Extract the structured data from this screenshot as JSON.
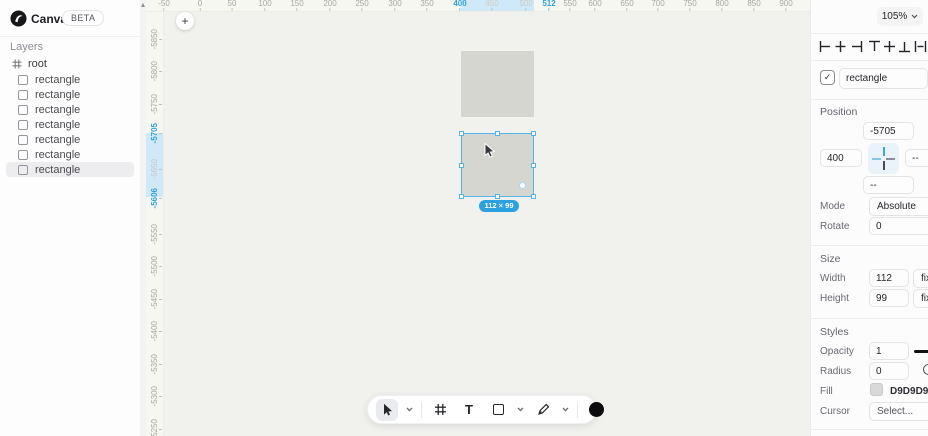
{
  "app": {
    "title": "Canvas",
    "badge": "BETA"
  },
  "sidebar": {
    "layers_title": "Layers",
    "root_label": "root",
    "items": [
      {
        "label": "rectangle"
      },
      {
        "label": "rectangle"
      },
      {
        "label": "rectangle"
      },
      {
        "label": "rectangle"
      },
      {
        "label": "rectangle"
      },
      {
        "label": "rectangle"
      },
      {
        "label": "rectangle",
        "c": "selected"
      }
    ]
  },
  "canvas": {
    "zoom_label": "105%",
    "plus_label": "+",
    "size_badge": "112 × 99",
    "ruler_top": [
      {
        "t": "-50",
        "x": 18
      },
      {
        "t": "0",
        "x": 54
      },
      {
        "t": "50",
        "x": 86
      },
      {
        "t": "100",
        "x": 119
      },
      {
        "t": "150",
        "x": 151
      },
      {
        "t": "200",
        "x": 184
      },
      {
        "t": "250",
        "x": 216
      },
      {
        "t": "300",
        "x": 249
      },
      {
        "t": "350",
        "x": 281
      },
      {
        "t": "400",
        "x": 314,
        "c": "accent"
      },
      {
        "t": "450",
        "x": 346,
        "c": "faint"
      },
      {
        "t": "500",
        "x": 380,
        "c": "faint"
      },
      {
        "t": "512",
        "x": 403,
        "c": "accent"
      },
      {
        "t": "550",
        "x": 424
      },
      {
        "t": "600",
        "x": 449
      },
      {
        "t": "650",
        "x": 481
      },
      {
        "t": "700",
        "x": 512
      },
      {
        "t": "750",
        "x": 544
      },
      {
        "t": "800",
        "x": 576
      },
      {
        "t": "850",
        "x": 608
      },
      {
        "t": "900",
        "x": 640
      }
    ],
    "ruler_left": [
      {
        "t": "-5850",
        "y": 28
      },
      {
        "t": "-5800",
        "y": 60
      },
      {
        "t": "-5750",
        "y": 93
      },
      {
        "t": "-5705",
        "y": 122,
        "c": "accent"
      },
      {
        "t": "-5650",
        "y": 158,
        "c": "faint"
      },
      {
        "t": "-5606",
        "y": 187,
        "c": "accent"
      },
      {
        "t": "-5550",
        "y": 223
      },
      {
        "t": "-5500",
        "y": 255
      },
      {
        "t": "-5450",
        "y": 288
      },
      {
        "t": "-5400",
        "y": 320
      },
      {
        "t": "-5350",
        "y": 353
      },
      {
        "t": "-5300",
        "y": 385
      },
      {
        "t": "-5250",
        "y": 418
      }
    ]
  },
  "toolbar": {
    "tools": [
      "select",
      "frame",
      "text",
      "rectangle",
      "pen",
      "color"
    ],
    "text_glyph": "T"
  },
  "inspector": {
    "name": {
      "value": "rectangle"
    },
    "position": {
      "title": "Position",
      "y_value": "-5705",
      "x_value": "400",
      "right_value": "--",
      "bottom_value": "--",
      "mode_label": "Mode",
      "mode_value": "Absolute",
      "rotate_label": "Rotate",
      "rotate_value": "0"
    },
    "size": {
      "title": "Size",
      "width_label": "Width",
      "width_value": "112",
      "width_mode": "fixed",
      "height_label": "Height",
      "height_value": "99",
      "height_mode": "fixed"
    },
    "styles": {
      "title": "Styles",
      "opacity_label": "Opacity",
      "opacity_value": "1",
      "radius_label": "Radius",
      "radius_value": "0",
      "fill_label": "Fill",
      "fill_value": "D9D9D9",
      "cursor_label": "Cursor",
      "cursor_placeholder": "Select..."
    }
  },
  "colors": {
    "accent_blue": "#2ea3e0",
    "selection_blue": "#54b5e6",
    "ruler_highlight": "#cfe9f8",
    "rect_fill": "#D9D9D9",
    "canvas_bg": "#f1f1ee"
  }
}
